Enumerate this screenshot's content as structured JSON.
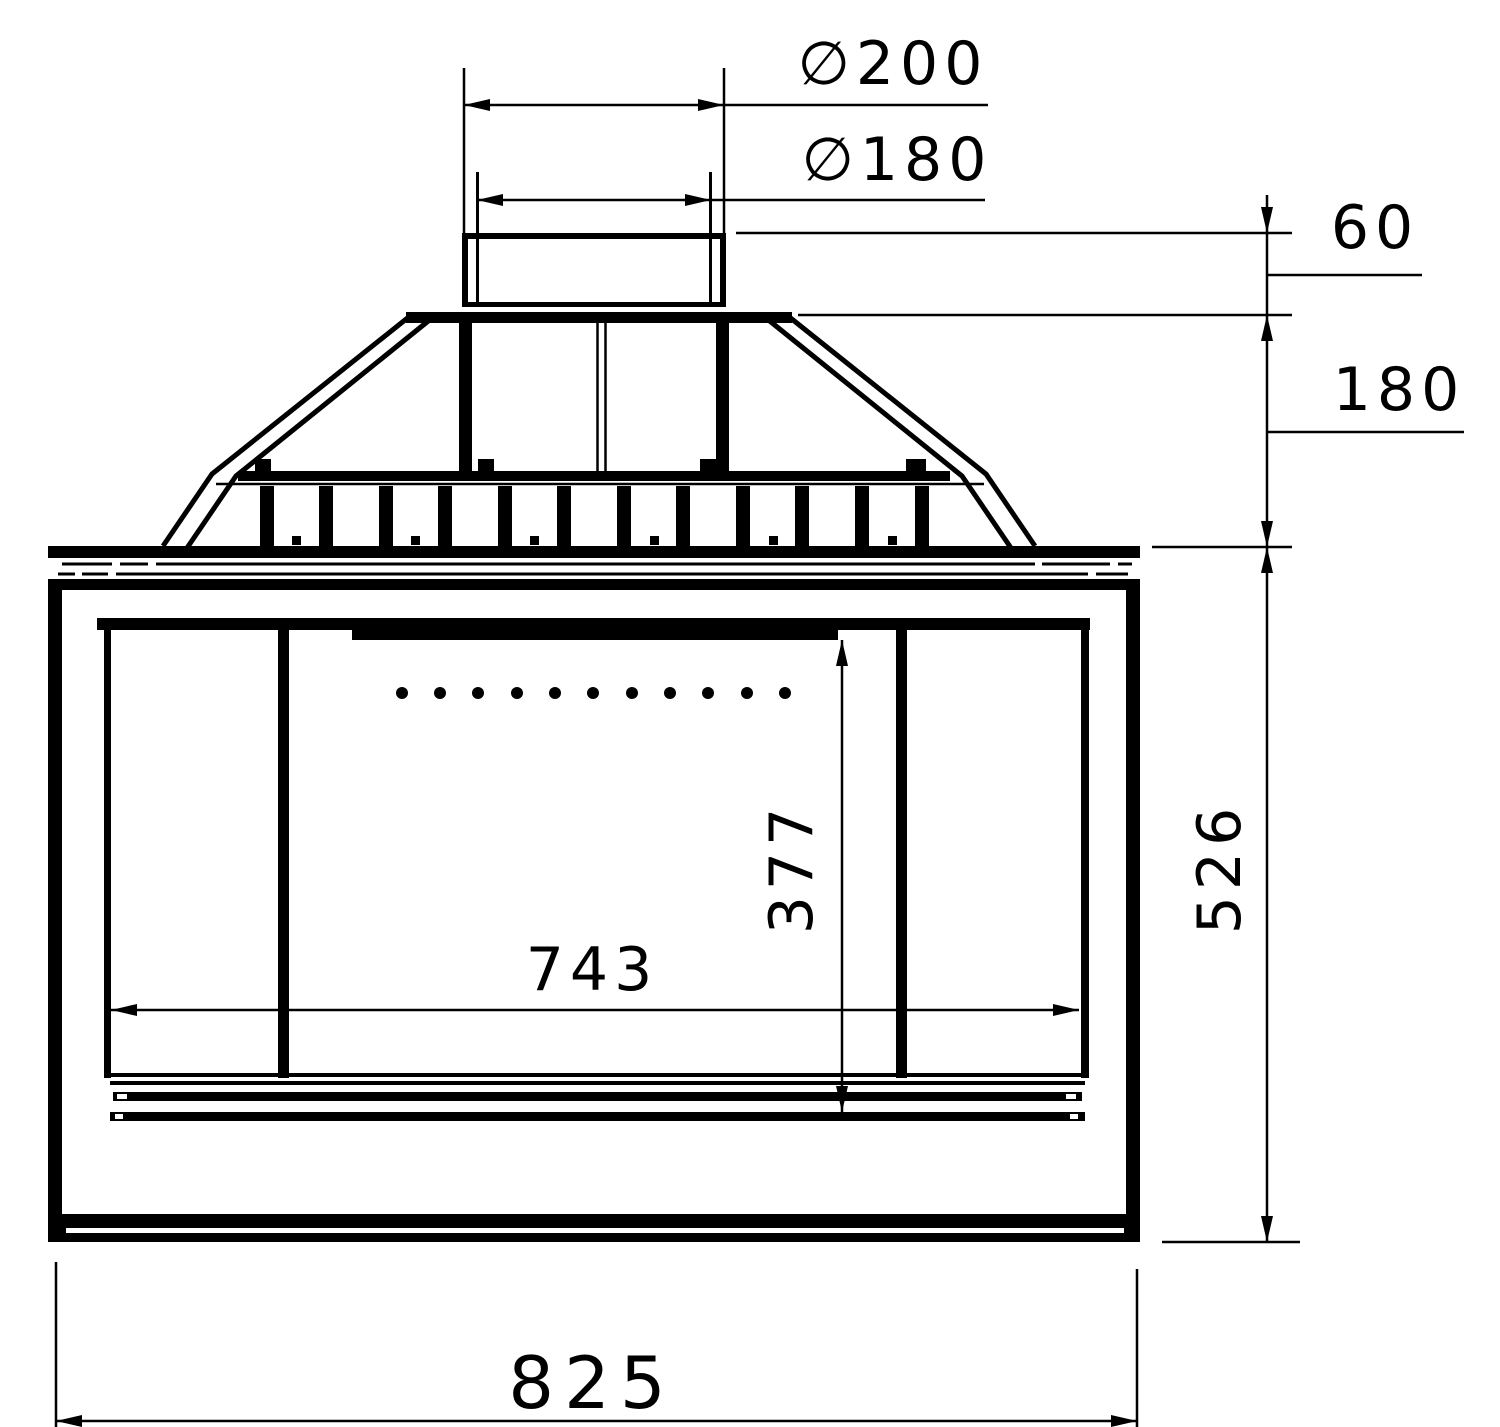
{
  "page": {
    "background_color": "#ffffff",
    "ink_color": "#000000"
  },
  "drawing": {
    "kind": "technical-dimension-drawing",
    "view": "fireplace-insert-front-elevation",
    "labels": {
      "flue_outer_diameter": "∅200",
      "flue_inner_diameter": "∅180",
      "collar_height": "60",
      "hood_height": "180",
      "body_height": "526",
      "opening_height": "377",
      "opening_width": "743",
      "overall_width": "825"
    }
  }
}
